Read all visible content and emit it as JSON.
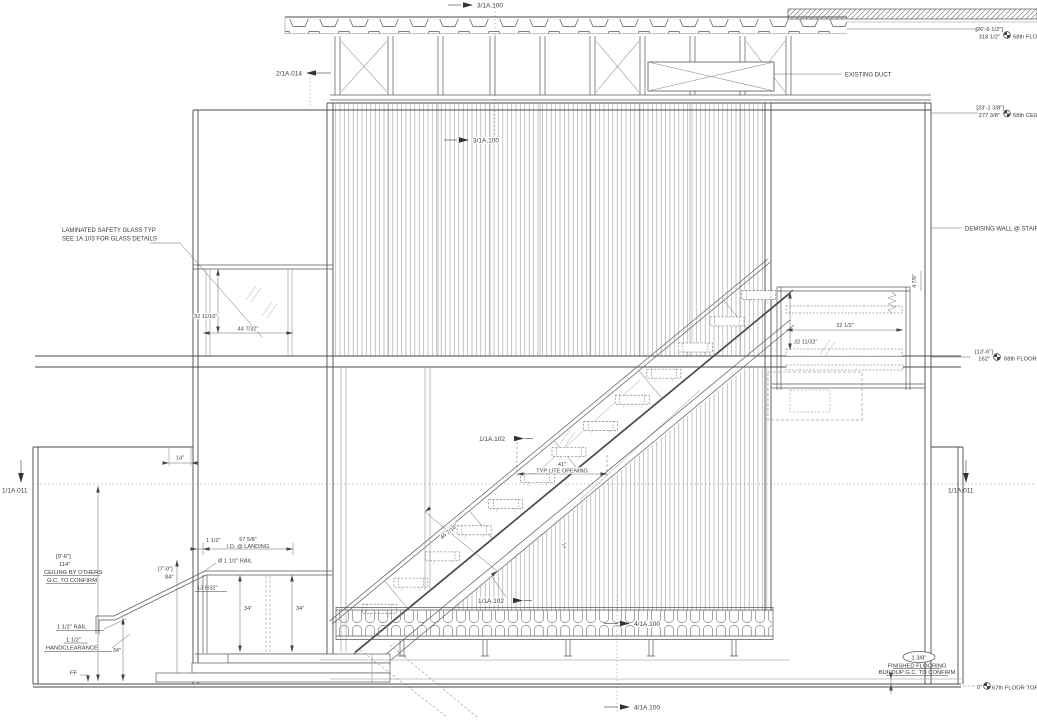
{
  "markers": {
    "m3_top": "3/1A.100",
    "m3_mid": "3/1A.100",
    "m2": "2/1A.014",
    "m102_upper": "1/1A.102",
    "m102_lower": "1/1A.102",
    "m1_left": "1/1A.011",
    "m1_right": "1/1A.011",
    "m4_bench": "4/1A.100",
    "m4_bottom": "4/1A.100"
  },
  "levels": {
    "floor68": {
      "bracket": "[26'-6 1/2\"]",
      "value": "318 1/2\"",
      "name": "68th FLOO"
    },
    "ceiling68": {
      "bracket": "[23'-1 3/8\"]",
      "value": "277 3/8\"",
      "name": "68th CEILI"
    },
    "floor68top": {
      "bracket": "[13'-6\"]",
      "value": "162\"",
      "name": "68th FLOOR TO"
    },
    "floor67": {
      "value": "0\"",
      "name": "67th FLOOR TOP O"
    }
  },
  "notes": {
    "duct": "EXISTING DUCT",
    "demising": "DEMISING WALL @ STAIR C",
    "glass1": "LAMINATED SAFETY GLASS TYP",
    "glass2": "SEE 1A.103 FOR GLASS DETAILS",
    "ceiling_bracket": "[9'-6\"]",
    "ceiling_value": "114\"",
    "ceiling1": "CEILING BY OTHERS",
    "ceiling2": "G.C. TO CONFIRM",
    "rail_dia": "Ø 1 1/2\" RAIL",
    "rail_label": "1 1/2\" RAIL",
    "hand1": "1 1/2\"",
    "hand2": "HANDCLEARANCE",
    "ff": "FF",
    "floor_oval": "1 3/8\"",
    "floor1": "FINISHED FLOORING",
    "floor2": "BUILDUP G.C. TO CONFIRM"
  },
  "dims": {
    "glass_h": "32 11/16\"",
    "glass_w": "44 7/32\"",
    "landing_w": "32 1/2\"",
    "landing_h": "32 11/32\"",
    "landing_side": "4 7/8\"",
    "lite_w": "41\"",
    "lite_label": "TYP LITE OPENING",
    "stair_run": "44 7/16\"",
    "tread_gap": "2\"",
    "wall14": "14\"",
    "h84_bracket": "[7'-0\"]",
    "h84_value": "84\"",
    "rail_t": "1 1/2\"",
    "landing_id_v": "57 5/8\"",
    "landing_id_l": "I.D. @ LANDING",
    "rail_o": "13 9/32\"",
    "h34_a": "34\"",
    "h34_b": "34\"",
    "h34_c": "34\""
  }
}
